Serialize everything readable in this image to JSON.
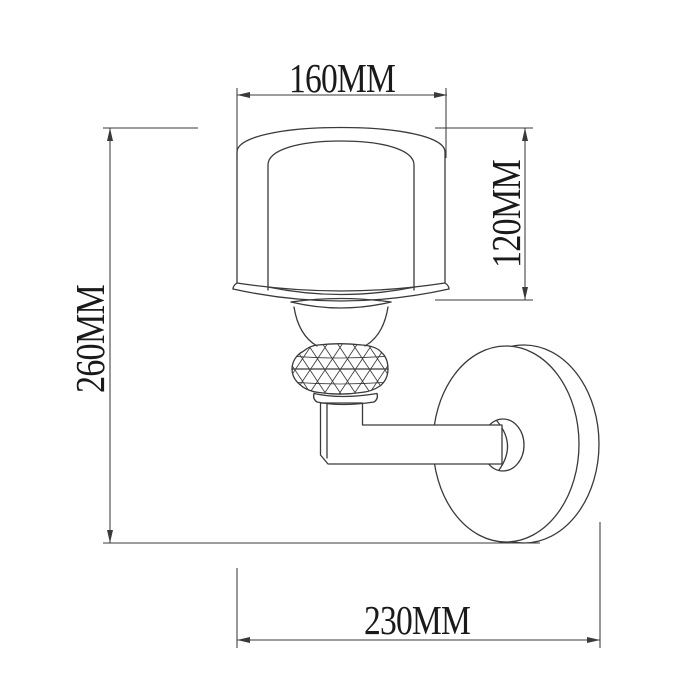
{
  "drawing": {
    "dims": {
      "width": {
        "label": "160MM"
      },
      "shade_height": {
        "label": "120MM"
      },
      "total_height": {
        "label": "260MM"
      },
      "depth": {
        "label": "230MM"
      }
    },
    "colors": {
      "line": "#3a3a3a",
      "text": "#1a1a1a",
      "background": "#ffffff"
    }
  }
}
